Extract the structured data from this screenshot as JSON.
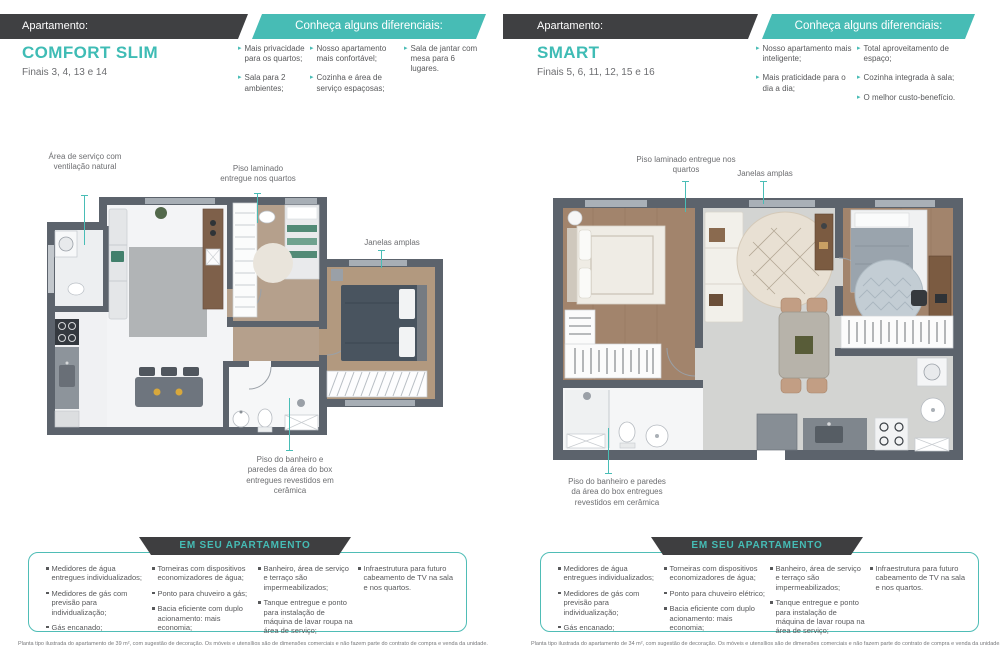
{
  "left": {
    "apartment_label": "Apartamento:",
    "title": "COMFORT SLIM",
    "finals": "Finais 3, 4, 13 e 14",
    "banner": "Conheça alguns diferenciais:",
    "diffs": [
      "Mais privacidade para os quartos;",
      "Sala para 2 ambientes;",
      "Nosso apartamento mais confortável;",
      "Cozinha e área de serviço espaçosas;",
      "Sala de jantar com mesa para 6 lugares."
    ],
    "annotations": {
      "service": "Área de serviço com ventilação natural",
      "laminate": "Piso laminado entregue nos quartos",
      "windows": "Janelas amplas",
      "ceramic": "Piso do banheiro e paredes da área do box entregues revestidos em cerâmica"
    },
    "features_title": "EM SEU APARTAMENTO",
    "features": [
      [
        "Medidores de água entregues individualizados;",
        "Medidores de gás com previsão para individualização;",
        "Gás encanado;"
      ],
      [
        "Torneiras com dispositivos economizadores de água;",
        "Ponto para chuveiro a gás;",
        "Bacia eficiente com duplo acionamento: mais economia;"
      ],
      [
        "Banheiro, área de serviço e terraço são impermeabilizados;",
        "Tanque entregue e ponto para instalação de máquina de lavar roupa na área de serviço;"
      ],
      [
        "Infraestrutura para futuro cabeamento de TV na sala e nos quartos."
      ]
    ],
    "fineprint": "Planta tipo ilustrada do apartamento de 39 m², com sugestão de decoração. Os móveis e utensílios são de dimensões comerciais e não fazem parte do contrato de compra e venda da unidade."
  },
  "right": {
    "apartment_label": "Apartamento:",
    "title": "SMART",
    "finals": "Finais 5, 6, 11, 12, 15 e 16",
    "banner": "Conheça alguns diferenciais:",
    "diffs": [
      "Nosso apartamento mais inteligente;",
      "Mais praticidade para o dia a dia;",
      "Total aproveitamento de espaço;",
      "Cozinha integrada à sala;",
      "O melhor custo-benefício."
    ],
    "annotations": {
      "laminate": "Piso laminado entregue nos quartos",
      "windows": "Janelas amplas",
      "ceramic": "Piso do banheiro e paredes da área do box entregues revestidos em cerâmica"
    },
    "features_title": "EM SEU APARTAMENTO",
    "features": [
      [
        "Medidores de água entregues individualizados;",
        "Medidores de gás com previsão para individualização;",
        "Gás encanado;"
      ],
      [
        "Torneiras com dispositivos economizadores de água;",
        "Ponto para chuveiro elétrico;",
        "Bacia eficiente com duplo acionamento: mais economia;"
      ],
      [
        "Banheiro, área de serviço e terraço são impermeabilizados;",
        "Tanque entregue e ponto para instalação de máquina de lavar roupa na área de serviço;"
      ],
      [
        "Infraestrutura para futuro cabeamento de TV na sala e nos quartos."
      ]
    ],
    "fineprint": "Planta tipo ilustrada do apartamento de 34 m², com sugestão de decoração. Os móveis e utensílios são de dimensões comerciais e não fazem parte do contrato de compra e venda da unidade."
  },
  "colors": {
    "teal": "#47BCB5",
    "dark_bar": "#3F4042",
    "wall": "#5C636C"
  }
}
